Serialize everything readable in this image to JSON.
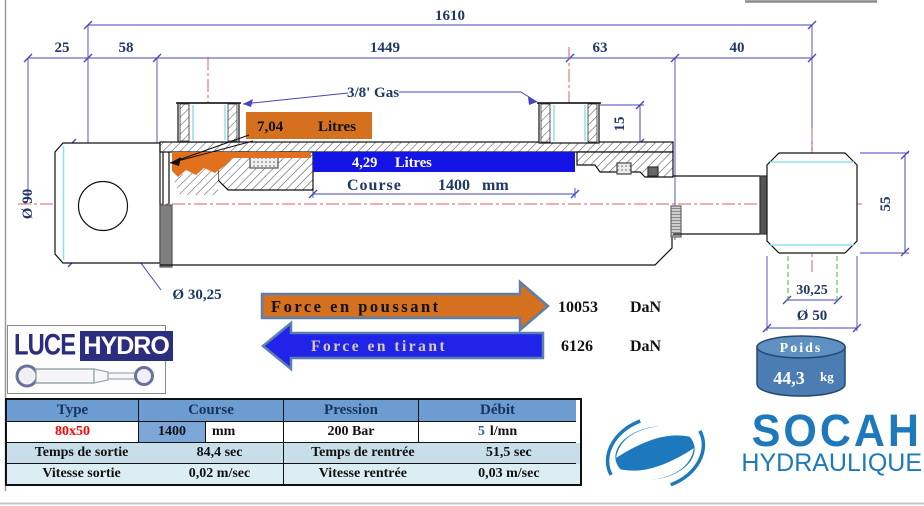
{
  "drawing": {
    "dim_total": "1610",
    "dim_25": "25",
    "dim_58": "58",
    "dim_1449": "1449",
    "dim_63": "63",
    "dim_40": "40",
    "dim_bore": "Ø 90",
    "dim_port_height": "15",
    "dim_rod_end_width": "55",
    "dim_eye": "Ø 30,25",
    "dim_rod_flat": "30,25",
    "dim_rod_dia": "Ø 50",
    "port_thread": "3/8' Gas",
    "push_volume": "7,04",
    "push_volume_unit": "Litres",
    "pull_volume": "4,29",
    "pull_volume_unit": "Litres",
    "course_label": "Course",
    "course_value": "1400",
    "course_unit": "mm"
  },
  "forces": {
    "push_label": "Force en poussant",
    "push_value": "10053",
    "push_unit": "DaN",
    "pull_label": "Force en tirant",
    "pull_value": "6126",
    "pull_unit": "DaN"
  },
  "weight": {
    "label": "Poids",
    "value": "44,3",
    "unit": "kg"
  },
  "logos": {
    "luce_left": "LUCE",
    "luce_right": "HYDRO",
    "socah_name": "SOCAH",
    "socah_sub": "HYDRAULIQUE"
  },
  "table": {
    "headers": [
      "Type",
      "Course",
      "Pression",
      "Débit"
    ],
    "type_value": "80x50",
    "course_value": "1400",
    "course_unit": "mm",
    "pression_value": "200 Bar",
    "debit_value": "5",
    "debit_unit": "l/mn",
    "rows": [
      {
        "label_left": "Temps de sortie",
        "value_left": "84,4 sec",
        "label_right": "Temps de rentrée",
        "value_right": "51,5 sec"
      },
      {
        "label_left": "Vitesse sortie",
        "value_left": "0,02 m/sec",
        "label_right": "Vitesse rentrée",
        "value_right": "0,03 m/sec"
      }
    ]
  },
  "colors": {
    "navy_text": "#1F3864",
    "dim_line": "#4545BD",
    "centerline_red": "#D86060",
    "cyan_accent": "#8FE0EA",
    "green_dashed": "#3CB83C",
    "orange": "#D4701E",
    "blue": "#1414E6",
    "arrow_outline": "#5B7FAE",
    "pull_text": "#D6CDA8",
    "table_header_bg": "#6D9CD1",
    "table_row3_bg": "#C8DFE9",
    "table_row4_bg": "#DDEDF4",
    "course_cell_bg": "#7CA5D8",
    "type_red": "#FF0000",
    "drum_blue": "#4B7DB3",
    "socah_blue": "#1D79BC",
    "luce_navy": "#2B2E7F"
  }
}
